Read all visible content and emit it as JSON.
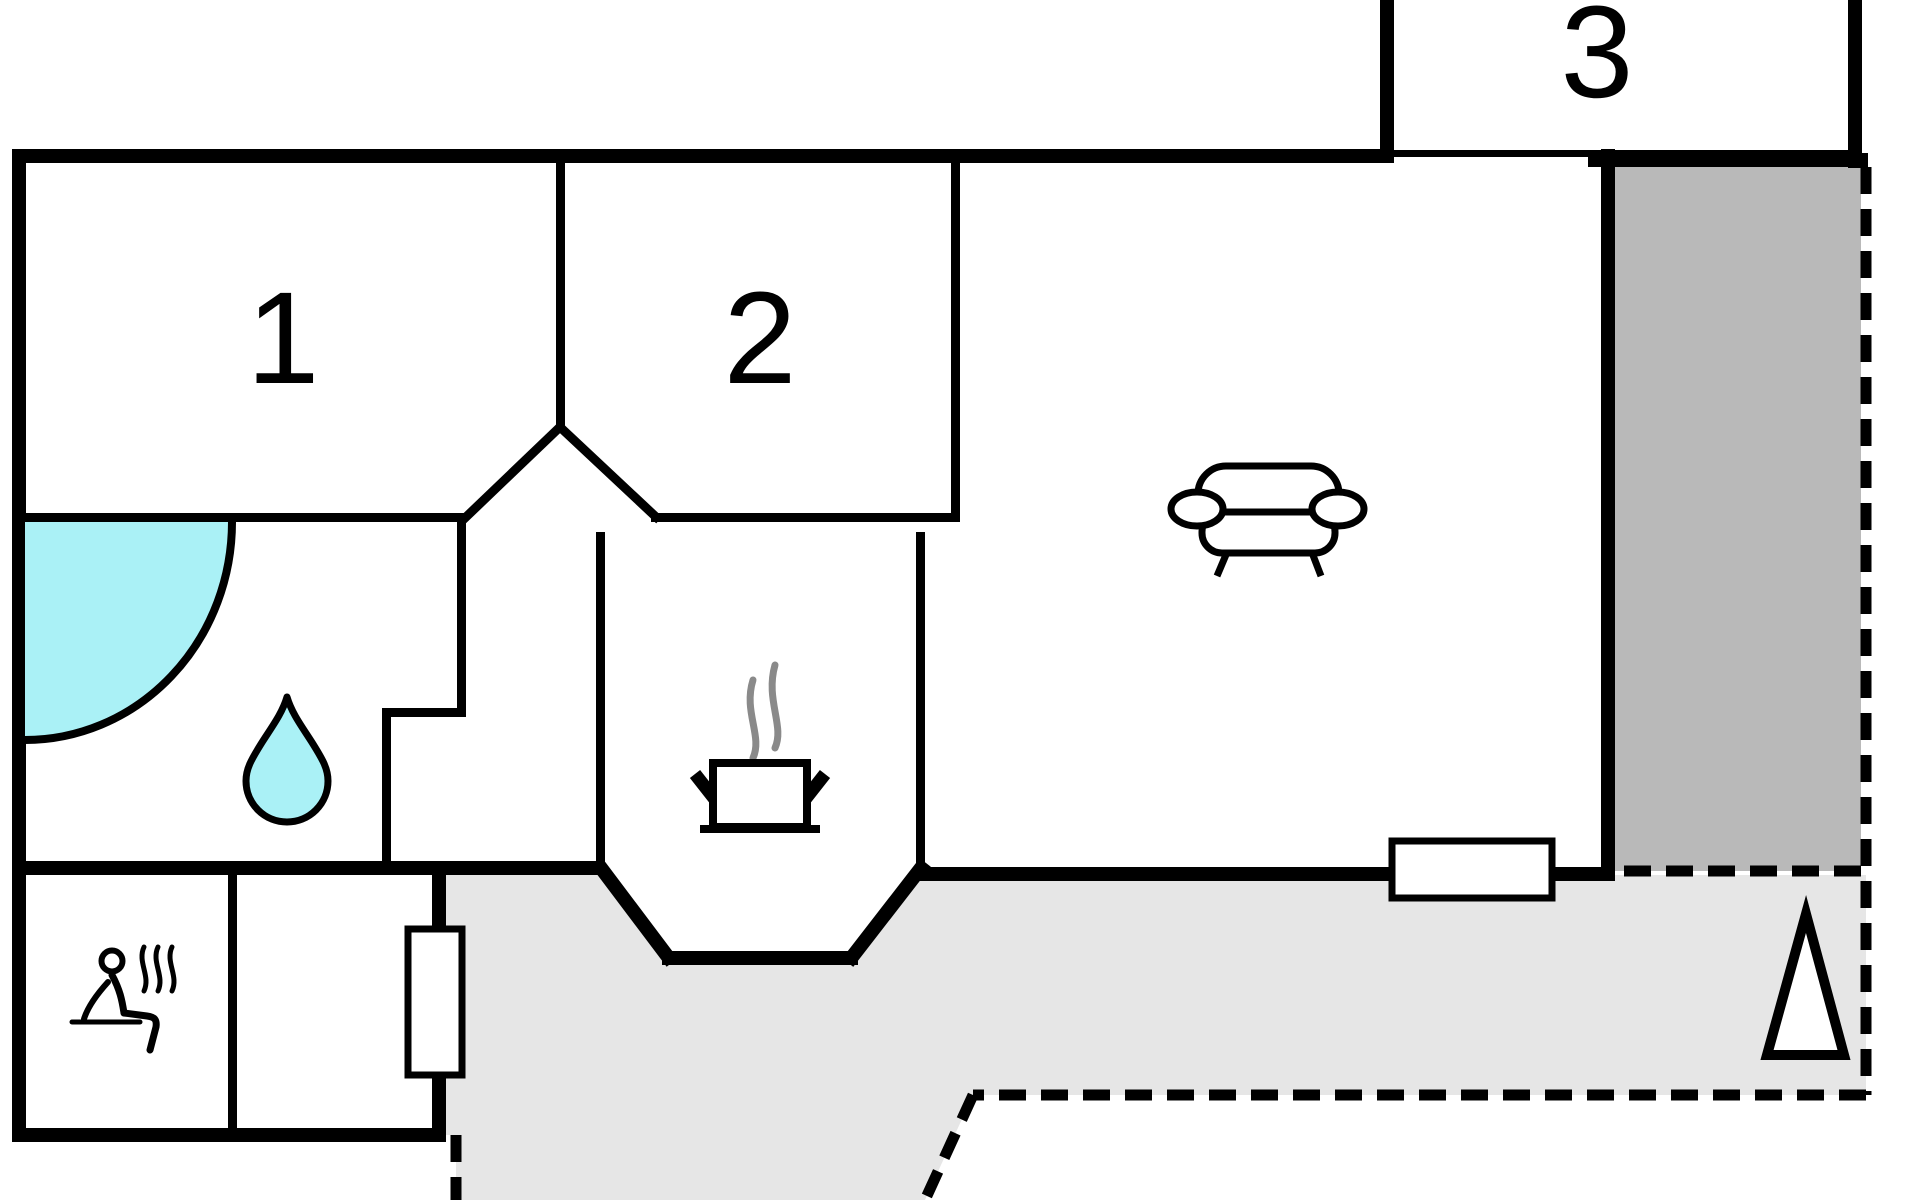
{
  "title": "floor-plan",
  "rooms": [
    {
      "id": "room-1",
      "label": "1",
      "type": "bedroom"
    },
    {
      "id": "room-2",
      "label": "2",
      "type": "bedroom"
    },
    {
      "id": "room-3",
      "label": "3",
      "type": "annex"
    }
  ],
  "icons": [
    {
      "name": "shower-icon",
      "meaning": "shower / bathroom",
      "shape": "cyan quarter circle"
    },
    {
      "name": "water-drop-icon",
      "meaning": "bathroom water drop",
      "shape": "cyan teardrop"
    },
    {
      "name": "sauna-icon",
      "meaning": "sauna (person on bench with steam)"
    },
    {
      "name": "cooking-pot-icon",
      "meaning": "kitchen (pot with steam)"
    },
    {
      "name": "sofa-icon",
      "meaning": "living room sofa"
    },
    {
      "name": "north-arrow-icon",
      "meaning": "orientation arrow",
      "shape": "white triangle"
    }
  ],
  "areas": [
    {
      "name": "covered-terrace",
      "fill": "dark-gray"
    },
    {
      "name": "open-terrace",
      "fill": "light-gray",
      "border": "dashed"
    }
  ],
  "colors": {
    "wall_black": "#000000",
    "pool_cyan": "#aaf1f6",
    "dark_terrace_gray": "#b9b9b9",
    "light_terrace_gray": "#e6e6e6",
    "steam_gray": "#8a8a8a",
    "background": "#ffffff"
  }
}
